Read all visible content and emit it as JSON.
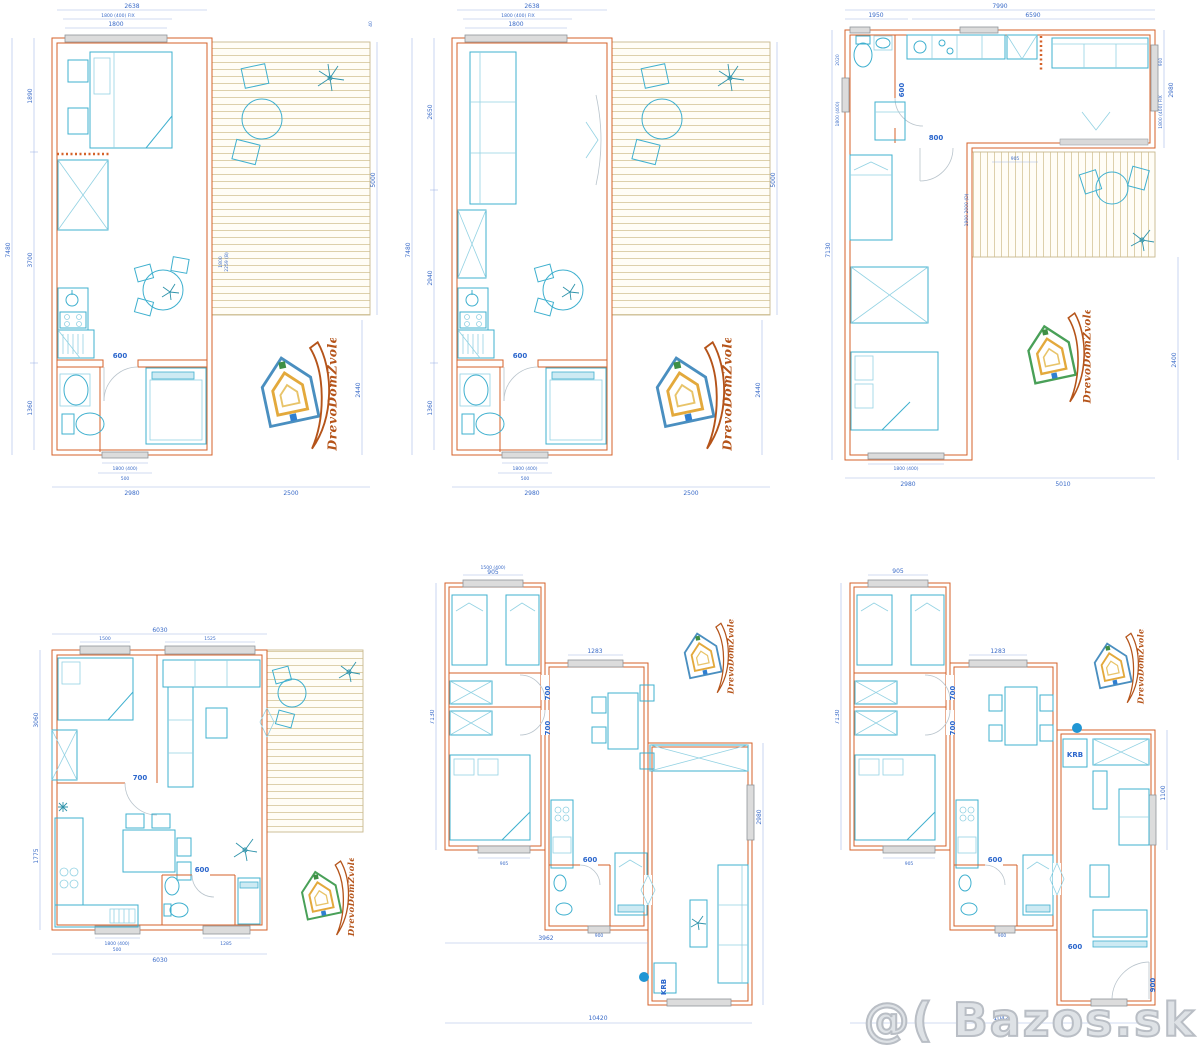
{
  "logo": {
    "text": "DrevoDomZvolen"
  },
  "watermark": {
    "text": "@( Bazos.sk"
  },
  "plans": {
    "p1": {
      "top_total": "2638",
      "top_window_fix": "1800 (400) FIX",
      "top_window": "1800",
      "left_total": "7480",
      "left_seg_top": "1890",
      "left_seg_mid": "3700",
      "left_seg_bottom": "1360",
      "right_top": "40",
      "right_terrace": "5000",
      "right_bottom": "2440",
      "bottom_window": "1800 (400)",
      "bottom_window2": "500",
      "bottom_house": "2980",
      "bottom_terrace": "2500",
      "door": "600",
      "slide_a": "1800",
      "slide_b": "2259 (B)"
    },
    "p2": {
      "top_total": "2638",
      "top_window_fix": "1800 (400) FIX",
      "top_window": "1800",
      "left_total": "7480",
      "left_seg_top": "2650",
      "left_seg_mid": "2940",
      "left_seg_bottom": "1360",
      "right_terrace": "5000",
      "right_bottom": "2440",
      "bottom_window": "1800 (400)",
      "bottom_window2": "500",
      "bottom_house": "2980",
      "bottom_terrace": "2500",
      "door": "600"
    },
    "p3": {
      "top_total": "7990",
      "top_seg_left": "1950",
      "top_seg_right": "6590",
      "left_total": "7130",
      "left_seg1": "2020",
      "left_seg2": "1800 (400)",
      "right_seg1": "900",
      "right_seg2": "1800 (400) FIX",
      "right_total": "2980",
      "right_lower": "2400",
      "bottom_house": "2980",
      "bottom_right": "5010",
      "bottom_window": "1800 (400)",
      "terrace_label": "905",
      "terrace_side": "1900 2000 (D)",
      "door_small": "600",
      "door_main": "800"
    },
    "p4": {
      "top_total": "6030",
      "window_left": "1500",
      "window_right": "1525",
      "left_top": "3060",
      "left_bottom": "1775",
      "bottom_total": "6030",
      "bottom_window": "1800 (400)",
      "bottom_window2": "500",
      "bottom_window_right": "1285",
      "door_interior": "700",
      "door_bath": "600"
    },
    "p5": {
      "top_window": "905",
      "top_window_small": "1500 (400)",
      "mid_window": "1283",
      "left_total": "7130",
      "right_side": "2980",
      "bottom_total": "10420",
      "bottom_mid": "3962",
      "door1": "700",
      "door2": "700",
      "door_bath": "600",
      "fireplace": "KRB",
      "win_left_module": "905",
      "win_mid_module": "900"
    },
    "p6": {
      "top_window": "905",
      "mid_window": "1283",
      "left_total": "7130",
      "right_side": "1100",
      "bottom_total": "10420",
      "door1": "700",
      "door2": "700",
      "door_bath": "600",
      "door_living": "600",
      "door_entry": "900",
      "fireplace": "KRB",
      "win_left_module": "905",
      "win_mid_module": "900"
    }
  }
}
